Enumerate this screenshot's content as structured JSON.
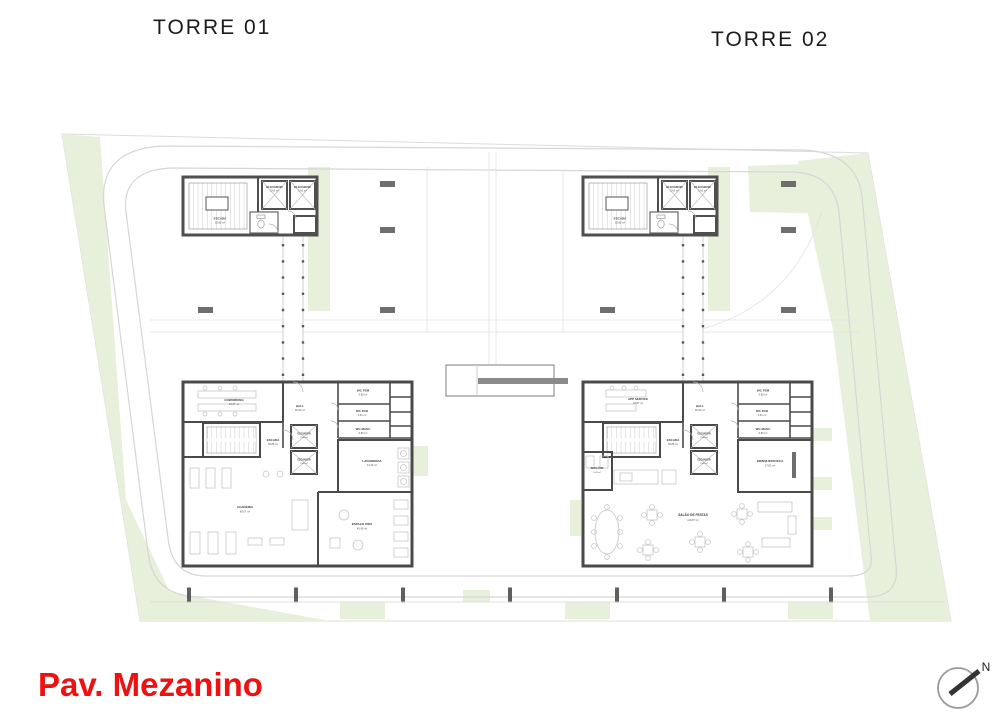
{
  "titles": {
    "tower1": "TORRE 01",
    "tower2": "TORRE 02"
  },
  "footer": {
    "floor_label": "Pav. Mezanino",
    "north_label": "N"
  },
  "colors": {
    "accent_red": "#ee1111",
    "wall": "#4a4a4a",
    "landscape_green": "#e7f0db",
    "road_line": "#d6d6d6"
  },
  "rooms": {
    "escada": {
      "name": "ESCADA",
      "area": "18.85 m²"
    },
    "elevador": {
      "name": "ELEVADOR",
      "area": "3.60 m²"
    },
    "hall": {
      "name": "HALL",
      "area": "30.09 m²"
    },
    "wc_fem": {
      "name": "WC FEM",
      "area": "6.80 m²"
    },
    "wc_pcd": {
      "name": "WC PCD",
      "area": "3.01 m²"
    },
    "wc_masc": {
      "name": "WC MASC",
      "area": "6.80 m²"
    }
  },
  "tower1": {
    "coworking": {
      "name": "COWORKING",
      "area": "19.87 m²"
    },
    "lavanderia": {
      "name": "LAVANDERIA",
      "area": "21.40 m²"
    },
    "academia": {
      "name": "ACADEMIA",
      "area": "85.07 m²"
    },
    "espaco_kids": {
      "name": "ESPAÇO KIDS",
      "area": "45.96 m²"
    }
  },
  "tower2": {
    "app_service": {
      "name": "APP SERVICE",
      "area": "18.87 m²"
    },
    "bercario": {
      "name": "BERÇÁRIO",
      "area": "5.63 m²"
    },
    "brinquedoteca": {
      "name": "BRINQUEDOTECA",
      "area": "27.83 m²"
    },
    "salao": {
      "name": "SALÃO DE FESTAS",
      "area": "119.87 m²"
    }
  }
}
